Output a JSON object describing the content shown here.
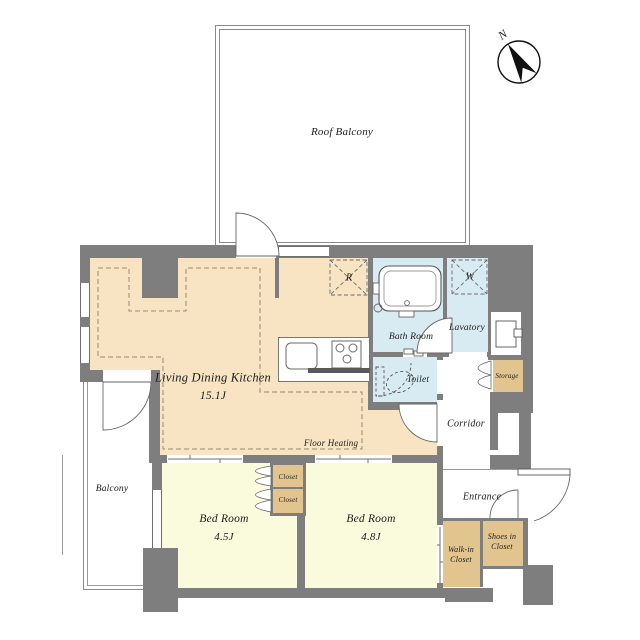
{
  "title": "Apartment floor plan",
  "colors": {
    "wall": "#7e7e7e",
    "ldk_floor": "#f8e4c3",
    "bedroom_floor": "#fafadc",
    "wet_floor": "#d9ebf2",
    "closet_floor": "#e2c48e",
    "heating_dash": "#9a8a70"
  },
  "compass": {
    "north_label": "N"
  },
  "rooms": {
    "roof_balcony": {
      "label": "Roof Balcony"
    },
    "ldk": {
      "label": "Living Dining Kitchen",
      "size": "15.1J"
    },
    "floor_heating": {
      "label": "Floor Heating"
    },
    "bath": {
      "label": "Bath Room"
    },
    "lavatory": {
      "label": "Lavatory"
    },
    "toilet": {
      "label": "Toilet"
    },
    "storage": {
      "label": "Storage"
    },
    "corridor": {
      "label": "Corridor"
    },
    "entrance": {
      "label": "Entrance"
    },
    "walk_in_closet": {
      "label": "Walk-in",
      "label2": "Closet"
    },
    "shoes_in_closet": {
      "label": "Shoes in",
      "label2": "Closet"
    },
    "bedroom1": {
      "label": "Bed Room",
      "size": "4.5J"
    },
    "bedroom2": {
      "label": "Bed Room",
      "size": "4.8J"
    },
    "closet_upper": {
      "label": "Closet"
    },
    "closet_lower": {
      "label": "Closet"
    },
    "balcony": {
      "label": "Balcony"
    }
  },
  "markers": {
    "refrigerator": "R",
    "washing_machine": "W"
  }
}
